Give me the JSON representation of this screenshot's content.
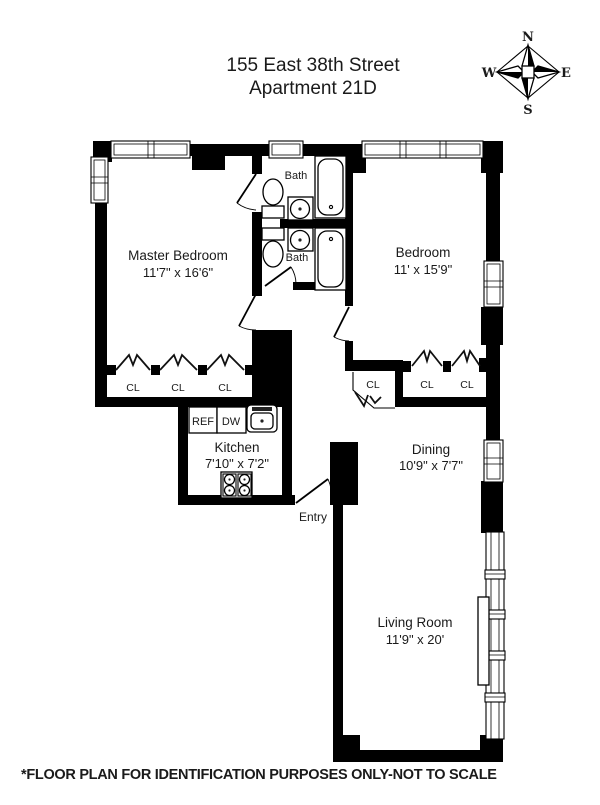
{
  "title": {
    "line1": "155 East 38th Street",
    "line2": "Apartment 21D"
  },
  "compass": {
    "n": "N",
    "e": "E",
    "s": "S",
    "w": "W"
  },
  "rooms": [
    {
      "name": "Master Bedroom",
      "dims": "11'7\" x 16'6\""
    },
    {
      "name": "Bedroom",
      "dims": "11' x 15'9\""
    },
    {
      "name": "Kitchen",
      "dims": "7'10\" x 7'2\""
    },
    {
      "name": "Dining",
      "dims": "10'9\" x 7'7\""
    },
    {
      "name": "Living Room",
      "dims": "11'9\" x 20'"
    }
  ],
  "labels": {
    "bath1": "Bath",
    "bath2": "Bath",
    "entry": "Entry",
    "ref": "REF",
    "dw": "DW"
  },
  "closets": {
    "master": [
      "CL",
      "CL",
      "CL"
    ],
    "dining": [
      "CL",
      "CL",
      "CL"
    ]
  },
  "footer": "*FLOOR PLAN FOR IDENTIFICATION PURPOSES ONLY-NOT TO SCALE",
  "colors": {
    "wall": "#000000",
    "background": "#ffffff"
  }
}
